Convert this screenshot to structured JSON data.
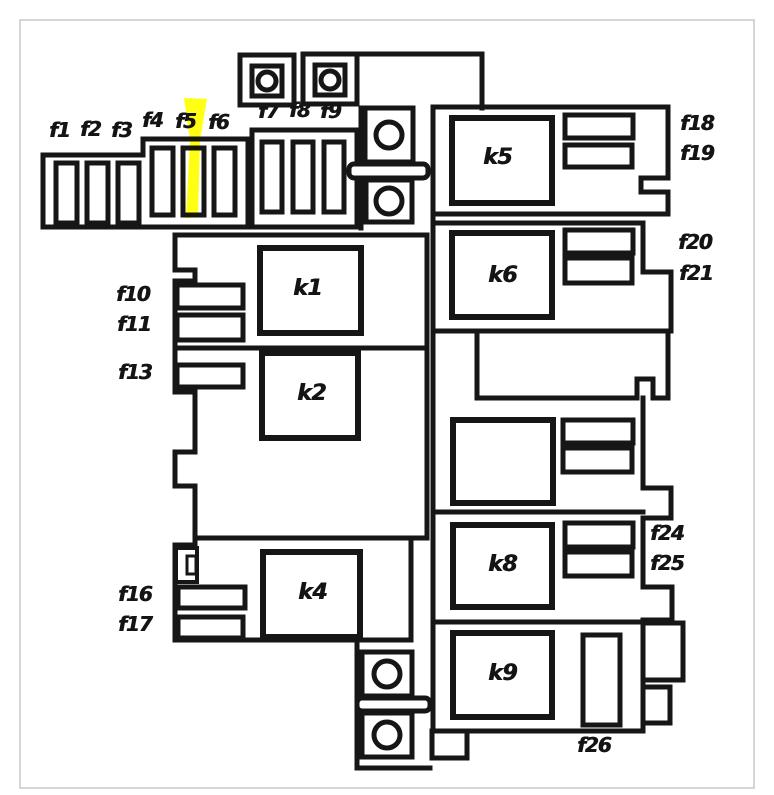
{
  "diagram": {
    "name": "fuse-relay-box-diagram",
    "highlight": {
      "fuse": "f5",
      "color": "#ffff00"
    },
    "colors": {
      "line": "#161616",
      "background": "#ffffff",
      "frame": "#d6d6d6",
      "label": "#141414"
    },
    "labels": {
      "f1": "f1",
      "f2": "f2",
      "f3": "f3",
      "f4": "f4",
      "f5": "f5",
      "f6": "f6",
      "f7": "f7",
      "f8": "f8",
      "f9": "f9",
      "f10": "f10",
      "f11": "f11",
      "f13": "f13",
      "f16": "f16",
      "f17": "f17",
      "f18": "f18",
      "f19": "f19",
      "f20": "f20",
      "f21": "f21",
      "f24": "f24",
      "f25": "f25",
      "f26": "f26",
      "k1": "k1",
      "k2": "k2",
      "k4": "k4",
      "k5": "k5",
      "k6": "k6",
      "k8": "k8",
      "k9": "k9"
    }
  }
}
